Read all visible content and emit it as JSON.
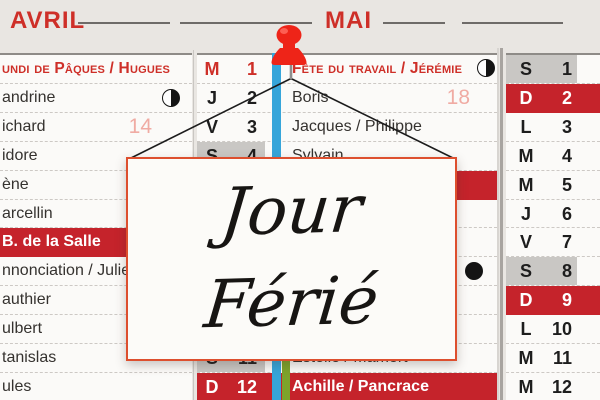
{
  "colors": {
    "red": "#ce2f28",
    "row-red": "#c5232b",
    "pink": "#f0aba3",
    "ribbon-blue": "#36a5da",
    "ribbon-green": "#7da32b",
    "gray-cell": "#c9c7c4",
    "sign-border": "#dd4f2e",
    "pin-red": "#ee2418"
  },
  "header": {
    "month_left": "AVRIL",
    "month_center": "MAI"
  },
  "sign": {
    "line1": "Jour",
    "line2": "Férié"
  },
  "april": {
    "row1": "undi de Pâques / Hugues",
    "week": "14",
    "rows": [
      "andrine",
      "ichard",
      "idore",
      "ène",
      "arcellin",
      "B. de la Salle",
      "nnonciation / Julie",
      "authier",
      "ulbert",
      "tanislas",
      "ules"
    ]
  },
  "may": {
    "row1_day": "M",
    "row1_num": "1",
    "row1_label": "Fête du travail / Jérémie",
    "week": "18",
    "rows": [
      {
        "day": "J",
        "num": "2",
        "name": "Boris"
      },
      {
        "day": "V",
        "num": "3",
        "name": "Jacques / Philippe"
      },
      {
        "day": "S",
        "num": "4",
        "name": "Sylvain"
      },
      {
        "day": "S",
        "num": "11",
        "name": "Estelle / Mamert"
      },
      {
        "day": "D",
        "num": "12",
        "name": "Achille / Pancrace"
      }
    ]
  },
  "june": {
    "rows": [
      {
        "day": "S",
        "num": "1"
      },
      {
        "day": "D",
        "num": "2"
      },
      {
        "day": "L",
        "num": "3"
      },
      {
        "day": "M",
        "num": "4"
      },
      {
        "day": "M",
        "num": "5"
      },
      {
        "day": "J",
        "num": "6"
      },
      {
        "day": "V",
        "num": "7"
      },
      {
        "day": "S",
        "num": "8"
      },
      {
        "day": "D",
        "num": "9"
      },
      {
        "day": "L",
        "num": "10"
      },
      {
        "day": "M",
        "num": "11"
      },
      {
        "day": "M",
        "num": "12"
      }
    ]
  }
}
